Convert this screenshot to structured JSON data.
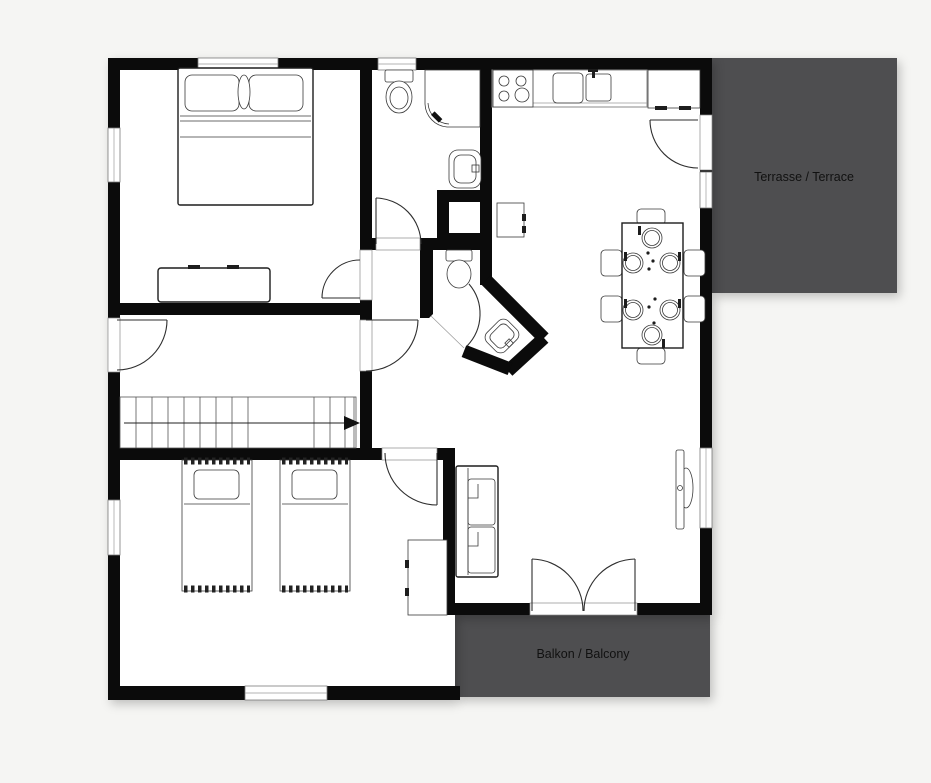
{
  "page": {
    "background_color": "#f5f5f3"
  },
  "plan": {
    "wall_color": "#0b0b0b",
    "interior_color": "#ffffff",
    "outdoor_area_color": "#4e4e50",
    "label_color": "#111111",
    "areas": {
      "terrace": {
        "label": "Terrasse / Terrace"
      },
      "balcony": {
        "label": "Balkon / Balcony"
      }
    }
  }
}
